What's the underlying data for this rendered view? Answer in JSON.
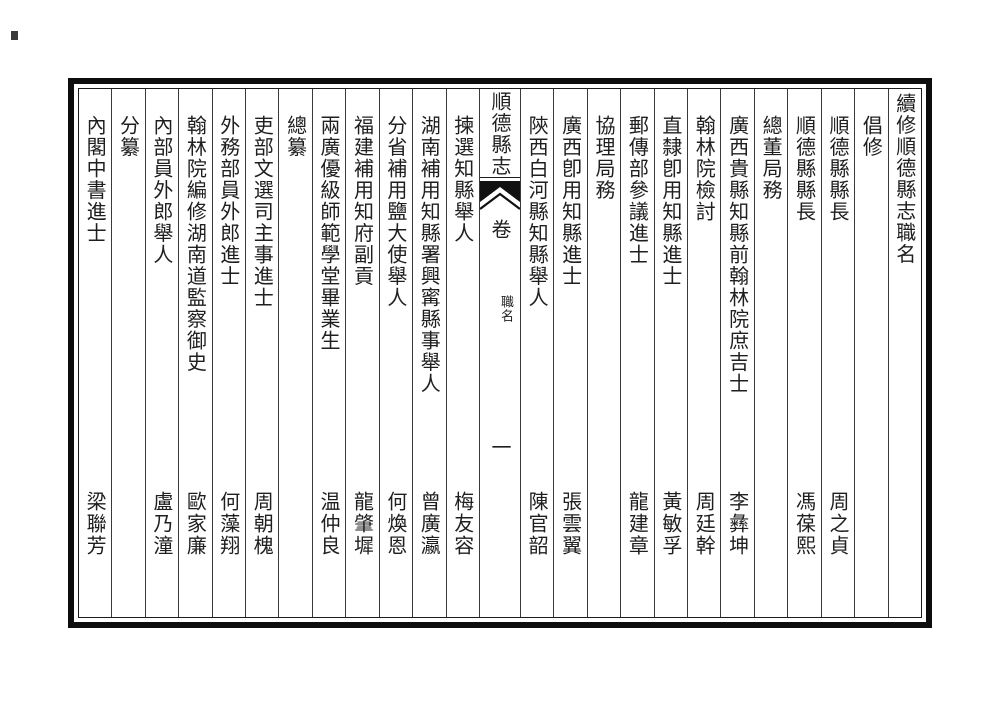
{
  "page": {
    "banxin": {
      "book_title": "順德縣志",
      "volume_label": "卷",
      "section_label": "職名",
      "volume_number": "一"
    },
    "ink_color": "#1f1f1f",
    "frame_color": "#0d0d0d"
  },
  "columns": [
    {
      "type": "title",
      "text": "續修順德縣志職名"
    },
    {
      "type": "header",
      "text": "倡修"
    },
    {
      "type": "entry",
      "office": "順德縣縣長",
      "name": "周之貞"
    },
    {
      "type": "entry",
      "office": "順德縣縣長",
      "name": "馮葆熙"
    },
    {
      "type": "header",
      "text": "總董局務"
    },
    {
      "type": "entry",
      "office": "廣西貴縣知縣前翰林院庶吉士",
      "name": "李彝坤"
    },
    {
      "type": "entry",
      "office": "翰林院檢討",
      "name": "周廷幹"
    },
    {
      "type": "entry",
      "office": "直隸卽用知縣進士",
      "name": "黃敏孚"
    },
    {
      "type": "entry",
      "office": "郵傳部參議進士",
      "name": "龍建章"
    },
    {
      "type": "header",
      "text": "協理局務"
    },
    {
      "type": "entry",
      "office": "廣西卽用知縣進士",
      "name": "張雲翼"
    },
    {
      "type": "entry",
      "office": "陝西白河縣知縣舉人",
      "name": "陳官韶"
    },
    {
      "type": "banxin"
    },
    {
      "type": "entry",
      "office": "揀選知縣舉人",
      "name": "梅友容"
    },
    {
      "type": "entry",
      "office": "湖南補用知縣署興寗縣事舉人",
      "name": "曾廣瀛"
    },
    {
      "type": "entry",
      "office": "分省補用鹽大使舉人",
      "name": "何煥恩"
    },
    {
      "type": "entry",
      "office": "福建補用知府副貢",
      "name": "龍肇墀"
    },
    {
      "type": "entry",
      "office": "兩廣優級師範學堂畢業生",
      "name": "温仲良"
    },
    {
      "type": "header",
      "text": "總纂"
    },
    {
      "type": "entry",
      "office": "吏部文選司主事進士",
      "name": "周朝槐"
    },
    {
      "type": "entry",
      "office": "外務部員外郎進士",
      "name": "何藻翔"
    },
    {
      "type": "entry",
      "office": "翰林院編修湖南道監察御史",
      "name": "歐家廉"
    },
    {
      "type": "entry",
      "office": "內部員外郎舉人",
      "name": "盧乃潼"
    },
    {
      "type": "header",
      "text": "分纂"
    },
    {
      "type": "entry",
      "office": "內閣中書進士",
      "name": "梁聯芳"
    }
  ]
}
